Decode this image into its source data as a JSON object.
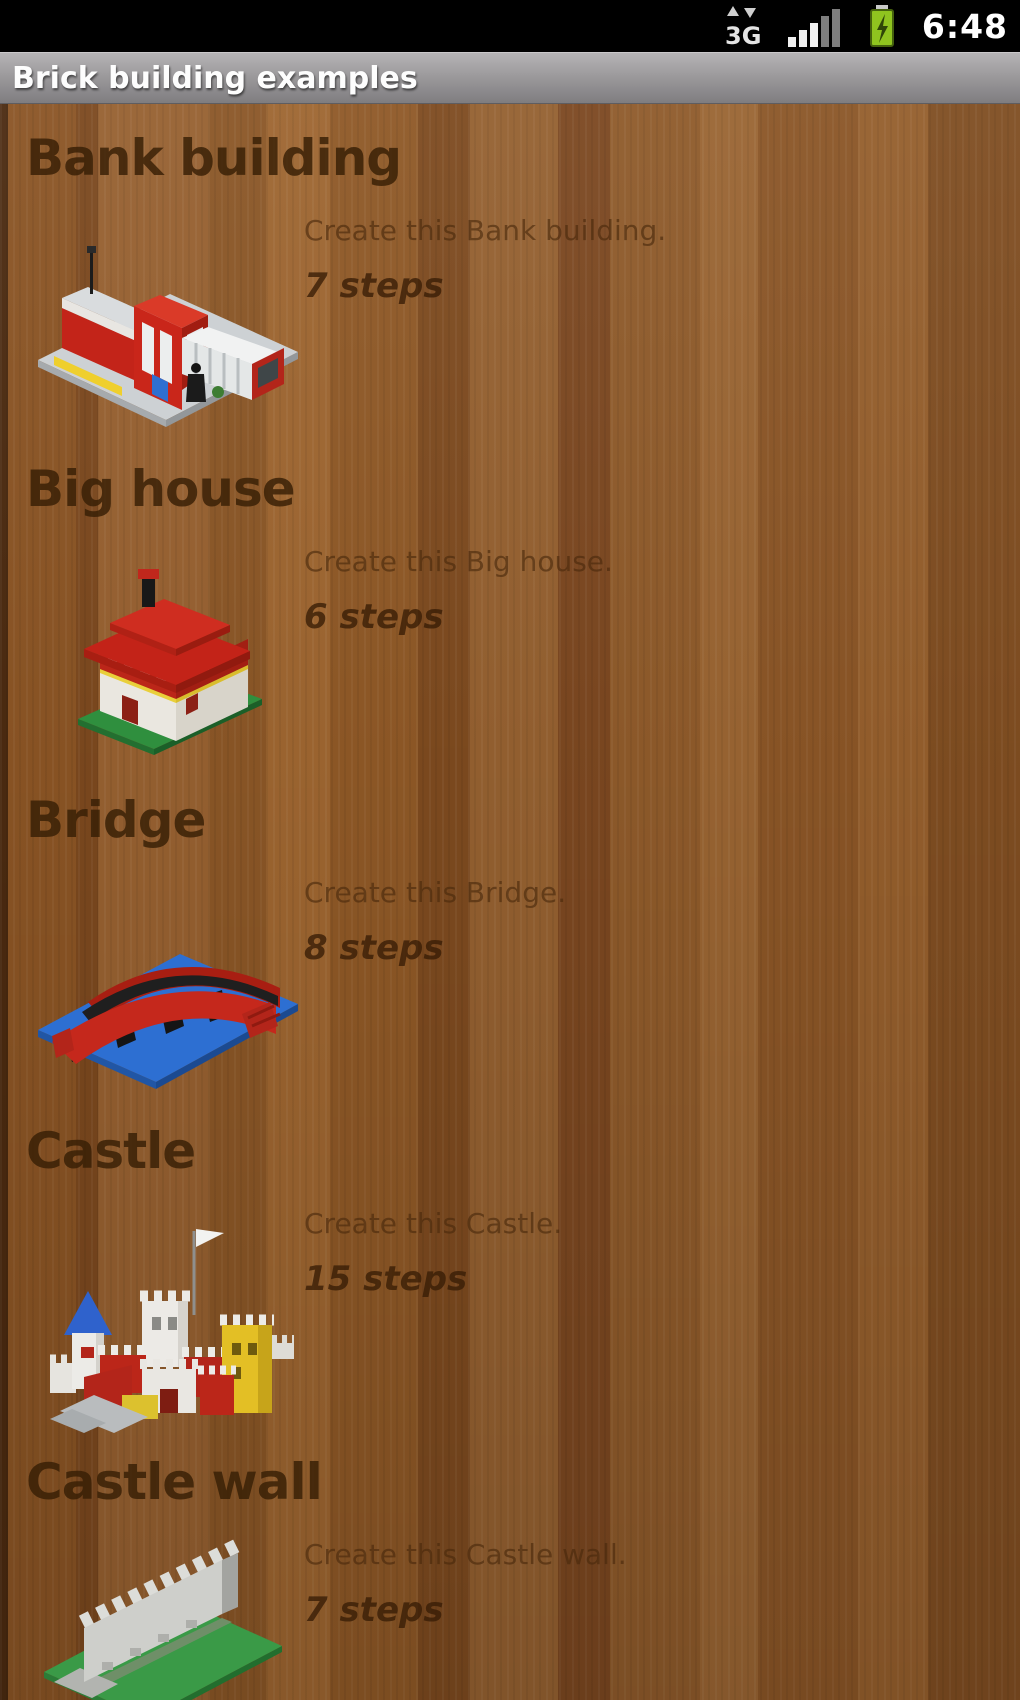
{
  "status_bar": {
    "time": "6:48",
    "network_label": "3G",
    "icons": {
      "network": "3g-data-updown-icon",
      "signal": "signal-strength-bars-icon",
      "battery": "battery-charging-icon"
    }
  },
  "title_bar": {
    "title": "Brick building examples"
  },
  "list": {
    "items": [
      {
        "title": "Bank building",
        "description": "Create this Bank building.",
        "steps": "7 steps",
        "image": "bank-building-model"
      },
      {
        "title": "Big house",
        "description": "Create this Big house.",
        "steps": "6 steps",
        "image": "big-house-model"
      },
      {
        "title": "Bridge",
        "description": "Create this Bridge.",
        "steps": "8 steps",
        "image": "bridge-model"
      },
      {
        "title": "Castle",
        "description": "Create this Castle.",
        "steps": "15 steps",
        "image": "castle-model"
      },
      {
        "title": "Castle wall",
        "description": "Create this Castle wall.",
        "steps": "7 steps",
        "image": "castle-wall-model"
      }
    ]
  },
  "colors": {
    "status_bar_bg": "#000000",
    "battery_green": "#8fc41f",
    "title_text": "#fdfdfd",
    "heading_text": "#4f2d0e",
    "description_text": "#6e4721",
    "steps_text": "#553312",
    "wood_base": "#8a5526",
    "brick_red": "#c3261b",
    "baseplate_gray": "#cdd1d4",
    "baseplate_blue": "#2d6fd2",
    "baseplate_green": "#3a9a47",
    "brick_yellow": "#e3bf25"
  }
}
